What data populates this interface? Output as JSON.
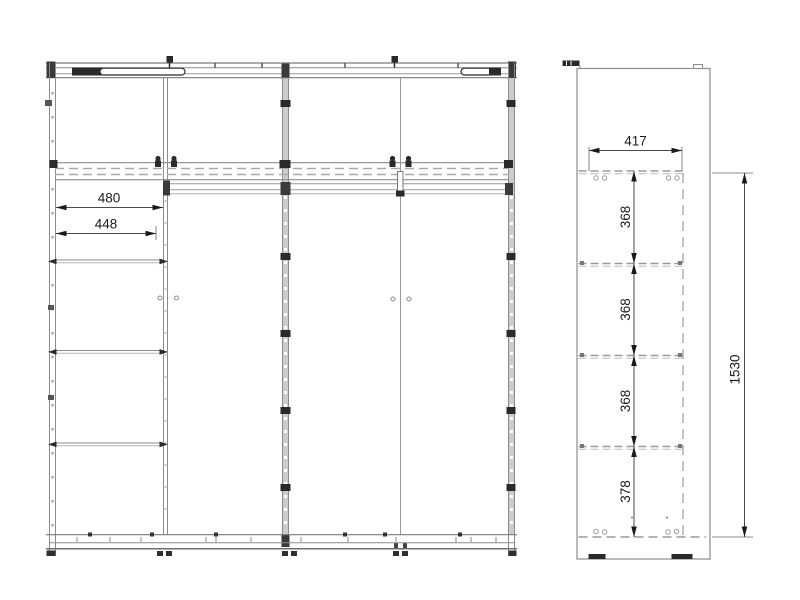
{
  "palette": {
    "carcass_line": "#8c8c8c",
    "strong_line": "#7a7a7a",
    "dashed_line": "#a9a9a9",
    "hardware_dark": "#2a2a2a",
    "panel_fill": "#cccccc",
    "dimension_line": "#4a4a4a",
    "dimension_text": "#1a1a1a"
  },
  "front_view": {
    "dimensions": {
      "shelf_width_outer": "480",
      "shelf_width_inner": "448"
    }
  },
  "side_view": {
    "dimensions": {
      "depth": "417",
      "bay_1": "368",
      "bay_2": "368",
      "bay_3": "368",
      "bay_4": "378",
      "interior_height": "1530"
    }
  }
}
